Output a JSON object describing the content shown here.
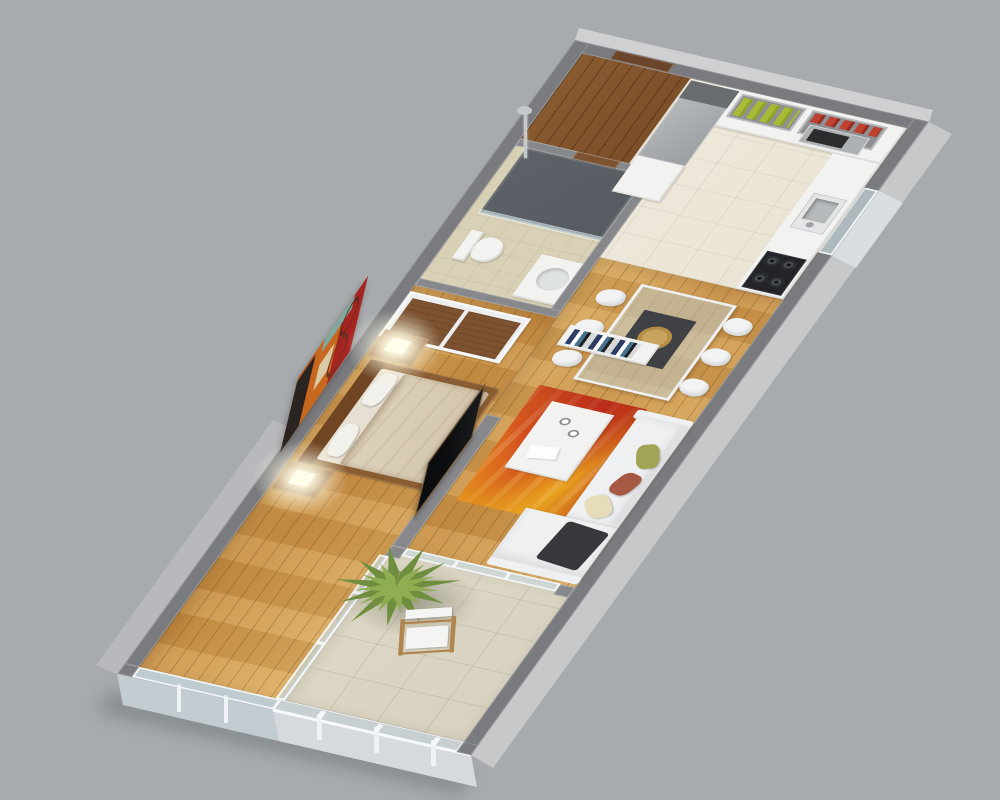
{
  "scene": {
    "type": "3d-apartment-floor-plan-render",
    "view": "isometric-cutaway",
    "rooms": [
      {
        "name": "entry-hall",
        "floor": "dark-walnut-wood"
      },
      {
        "name": "kitchen",
        "floor": "beige-ceramic-tile",
        "furniture": [
          "fridge",
          "tall-cabinet",
          "l-shaped-counter",
          "open-shelves",
          "green-bottles",
          "red-canisters",
          "microwave",
          "sink",
          "gas-cooktop",
          "window"
        ]
      },
      {
        "name": "bathroom",
        "floor": "beige-tile-with-dark-shower-zone",
        "furniture": [
          "shower-column",
          "shower-tray",
          "glass-screen",
          "toilet",
          "vanity-sink",
          "door"
        ]
      },
      {
        "name": "living-dining",
        "floor": "honey-oak-plank",
        "furniture": [
          "glass-dining-table",
          "six-white-chairs",
          "table-runner",
          "woven-plate",
          "low-bookshelf",
          "white-sofa-with-chaise",
          "pillows",
          "dark-throw",
          "white-coffee-table",
          "cups",
          "magazines",
          "red-orange-rug",
          "tv-partition-wall",
          "sliding-glass-door"
        ]
      },
      {
        "name": "bedroom",
        "floor": "honey-oak-plank",
        "furniture": [
          "wardrobe-wood-sliding-doors",
          "double-bed-wood-frame",
          "beige-duvet",
          "white-pillows",
          "two-nightstands",
          "two-glowing-cube-lamps",
          "abstract-wall-painting",
          "wall-tv",
          "end-window-wall"
        ]
      },
      {
        "name": "balcony",
        "floor": "stone-tile",
        "furniture": [
          "potted-yucca-plant",
          "directors-chair",
          "glass-railing",
          "glass-divider"
        ]
      }
    ]
  },
  "palette": {
    "bg": "#a7abae",
    "wall_top": "#7a7b7f",
    "wall_int": "#87888c",
    "wall_face": "#c7c8ca",
    "wall_face_dark": "#b8b9bc",
    "shadow": "#5f6367",
    "wood_base": "#c99045",
    "wood_hi": "#dcae63",
    "wood_dark": "#7c4e28",
    "tile_kitchen": "#e9e3d3",
    "tile_bath": "#d8d1b6",
    "tile_balcony": "#d7d1bf",
    "shower_floor": "#565b61",
    "counter": "#f2f2f0",
    "fridge": "#9b9ea1",
    "steel": "#aeb1b4",
    "appliance": "#222428",
    "shelf": "#8e9093",
    "greens": "#a9ba35",
    "reds": "#bf4231",
    "runner": "#3f4144",
    "plate": "#c9a45f",
    "seat": "#f2f3f4",
    "sofa": "#eff0f1",
    "throw": "#36383b",
    "p_olive": "#a0a455",
    "p_rust": "#a65a43",
    "p_cream": "#e6dcba",
    "rug_a": "#e06a1f",
    "rug_b": "#c9331c",
    "rug_c": "#e8a21f",
    "rug_d": "#b32817",
    "wood_furn": "#8a5c32",
    "headboard": "#6f4524",
    "wardrobe_door": "#7c5230",
    "mattress": "#e6e0d2",
    "duvet": "#d3c5ac",
    "lamp_glow": "#fff8dc",
    "paint_black": "#2a2420",
    "paint_orange": "#c8681e",
    "paint_red": "#a82420",
    "paint_teal": "#7fa89e",
    "paint_cream": "#d9c9a4",
    "tv": "#0c0d0e",
    "tv_frame": "#7a5c38",
    "plant_a": "#6f8f3f",
    "plant_b": "#8fae52",
    "pot": "#b3a284",
    "chair_wood": "#b08550",
    "canvas": "#f4f4f2"
  }
}
